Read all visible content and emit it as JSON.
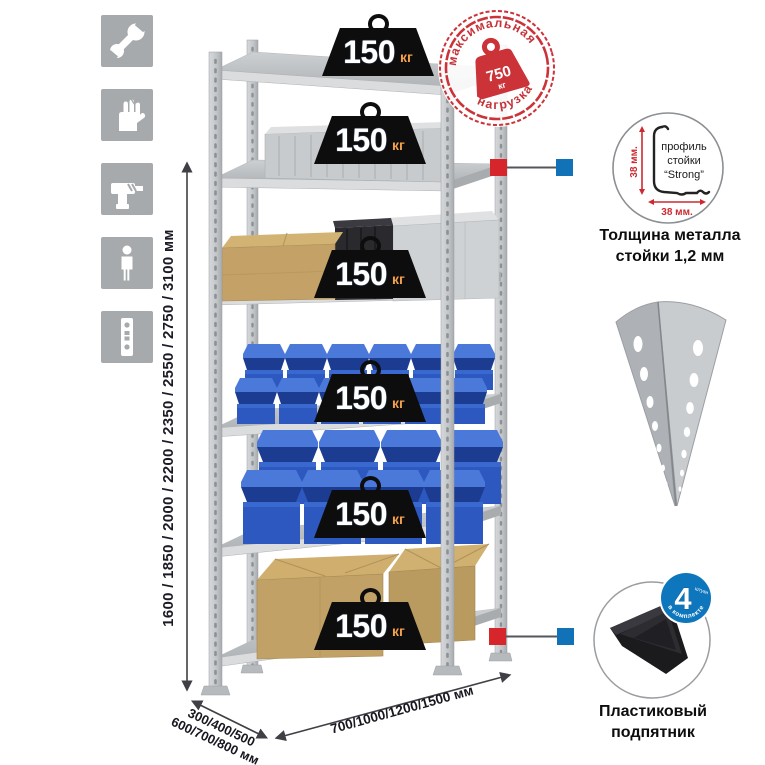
{
  "sidebar": {
    "icons": [
      "wrench-icon",
      "gloves-icon",
      "drill-icon",
      "person-icon",
      "perforated-profile-icon"
    ]
  },
  "rack": {
    "shelf_count": 6,
    "load_label": {
      "value": "150",
      "unit": "кг"
    }
  },
  "stamp": {
    "arc_top": "максимальная",
    "arc_bottom": "нагрузка",
    "value": "750",
    "unit": "кг"
  },
  "dimensions": {
    "height": "1600 / 1850 / 2000 / 2200 / 2350 / 2550 / 2750 / 3100 мм",
    "depth_line1": "300/400/500",
    "depth_line2": "600/700/800 мм",
    "width": "700/1000/1200/1500 мм"
  },
  "profile_detail": {
    "label_line1": "профиль",
    "label_line2": "стойки",
    "label_line3": "“Strong”",
    "dim_vertical": "38 мм.",
    "dim_horizontal": "38 мм.",
    "caption_line1": "Толщина металла",
    "caption_line2": "стойки 1,2 мм"
  },
  "foot_detail": {
    "badge_value": "4",
    "badge_unit": "штуки",
    "badge_arc": "в комплекте",
    "caption_line1": "Пластиковый",
    "caption_line2": "подпятник"
  },
  "colors": {
    "stamp_red": "#cb3339",
    "marker_red": "#d6262c",
    "marker_blue": "#1172b8",
    "bin_blue": "#2c58c0",
    "weight_black": "#0d0d0d",
    "icon_gray": "#a7aaac"
  }
}
